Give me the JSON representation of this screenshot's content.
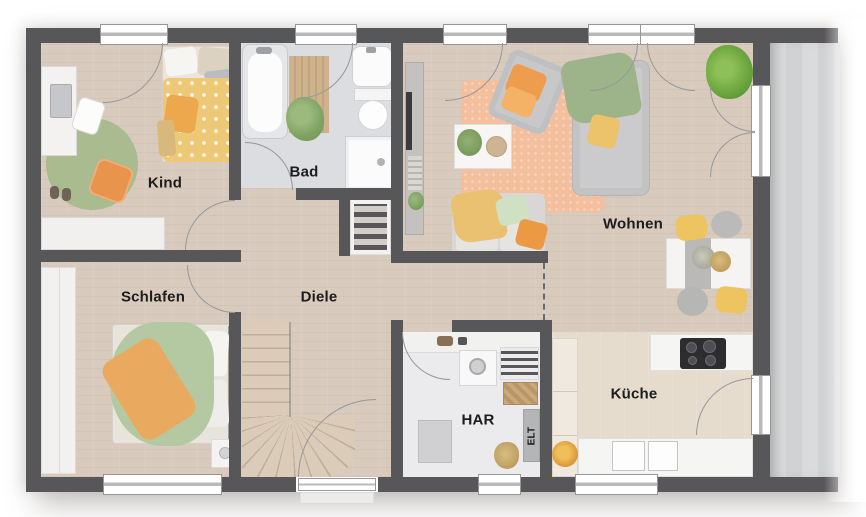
{
  "rooms": {
    "kind": {
      "label": "Kind"
    },
    "bad": {
      "label": "Bad"
    },
    "wohnen": {
      "label": "Wohnen"
    },
    "schlafen": {
      "label": "Schlafen"
    },
    "diele": {
      "label": "Diele"
    },
    "kueche": {
      "label": "Küche"
    },
    "har": {
      "label": "HAR"
    },
    "elt": {
      "label": "ELT"
    }
  },
  "colors": {
    "wall": "#575659",
    "wood_floor": "#d8cbbd",
    "bath_floor": "#dcdde0",
    "utility_floor": "#ebebed",
    "kitchen_floor": "#e6dccd",
    "terrace": "#d6d7d9",
    "accent_orange": "#e8944d",
    "accent_yellow": "#ecc26a",
    "accent_green": "#a9bb8f",
    "accent_peach": "#f4bf9d"
  }
}
